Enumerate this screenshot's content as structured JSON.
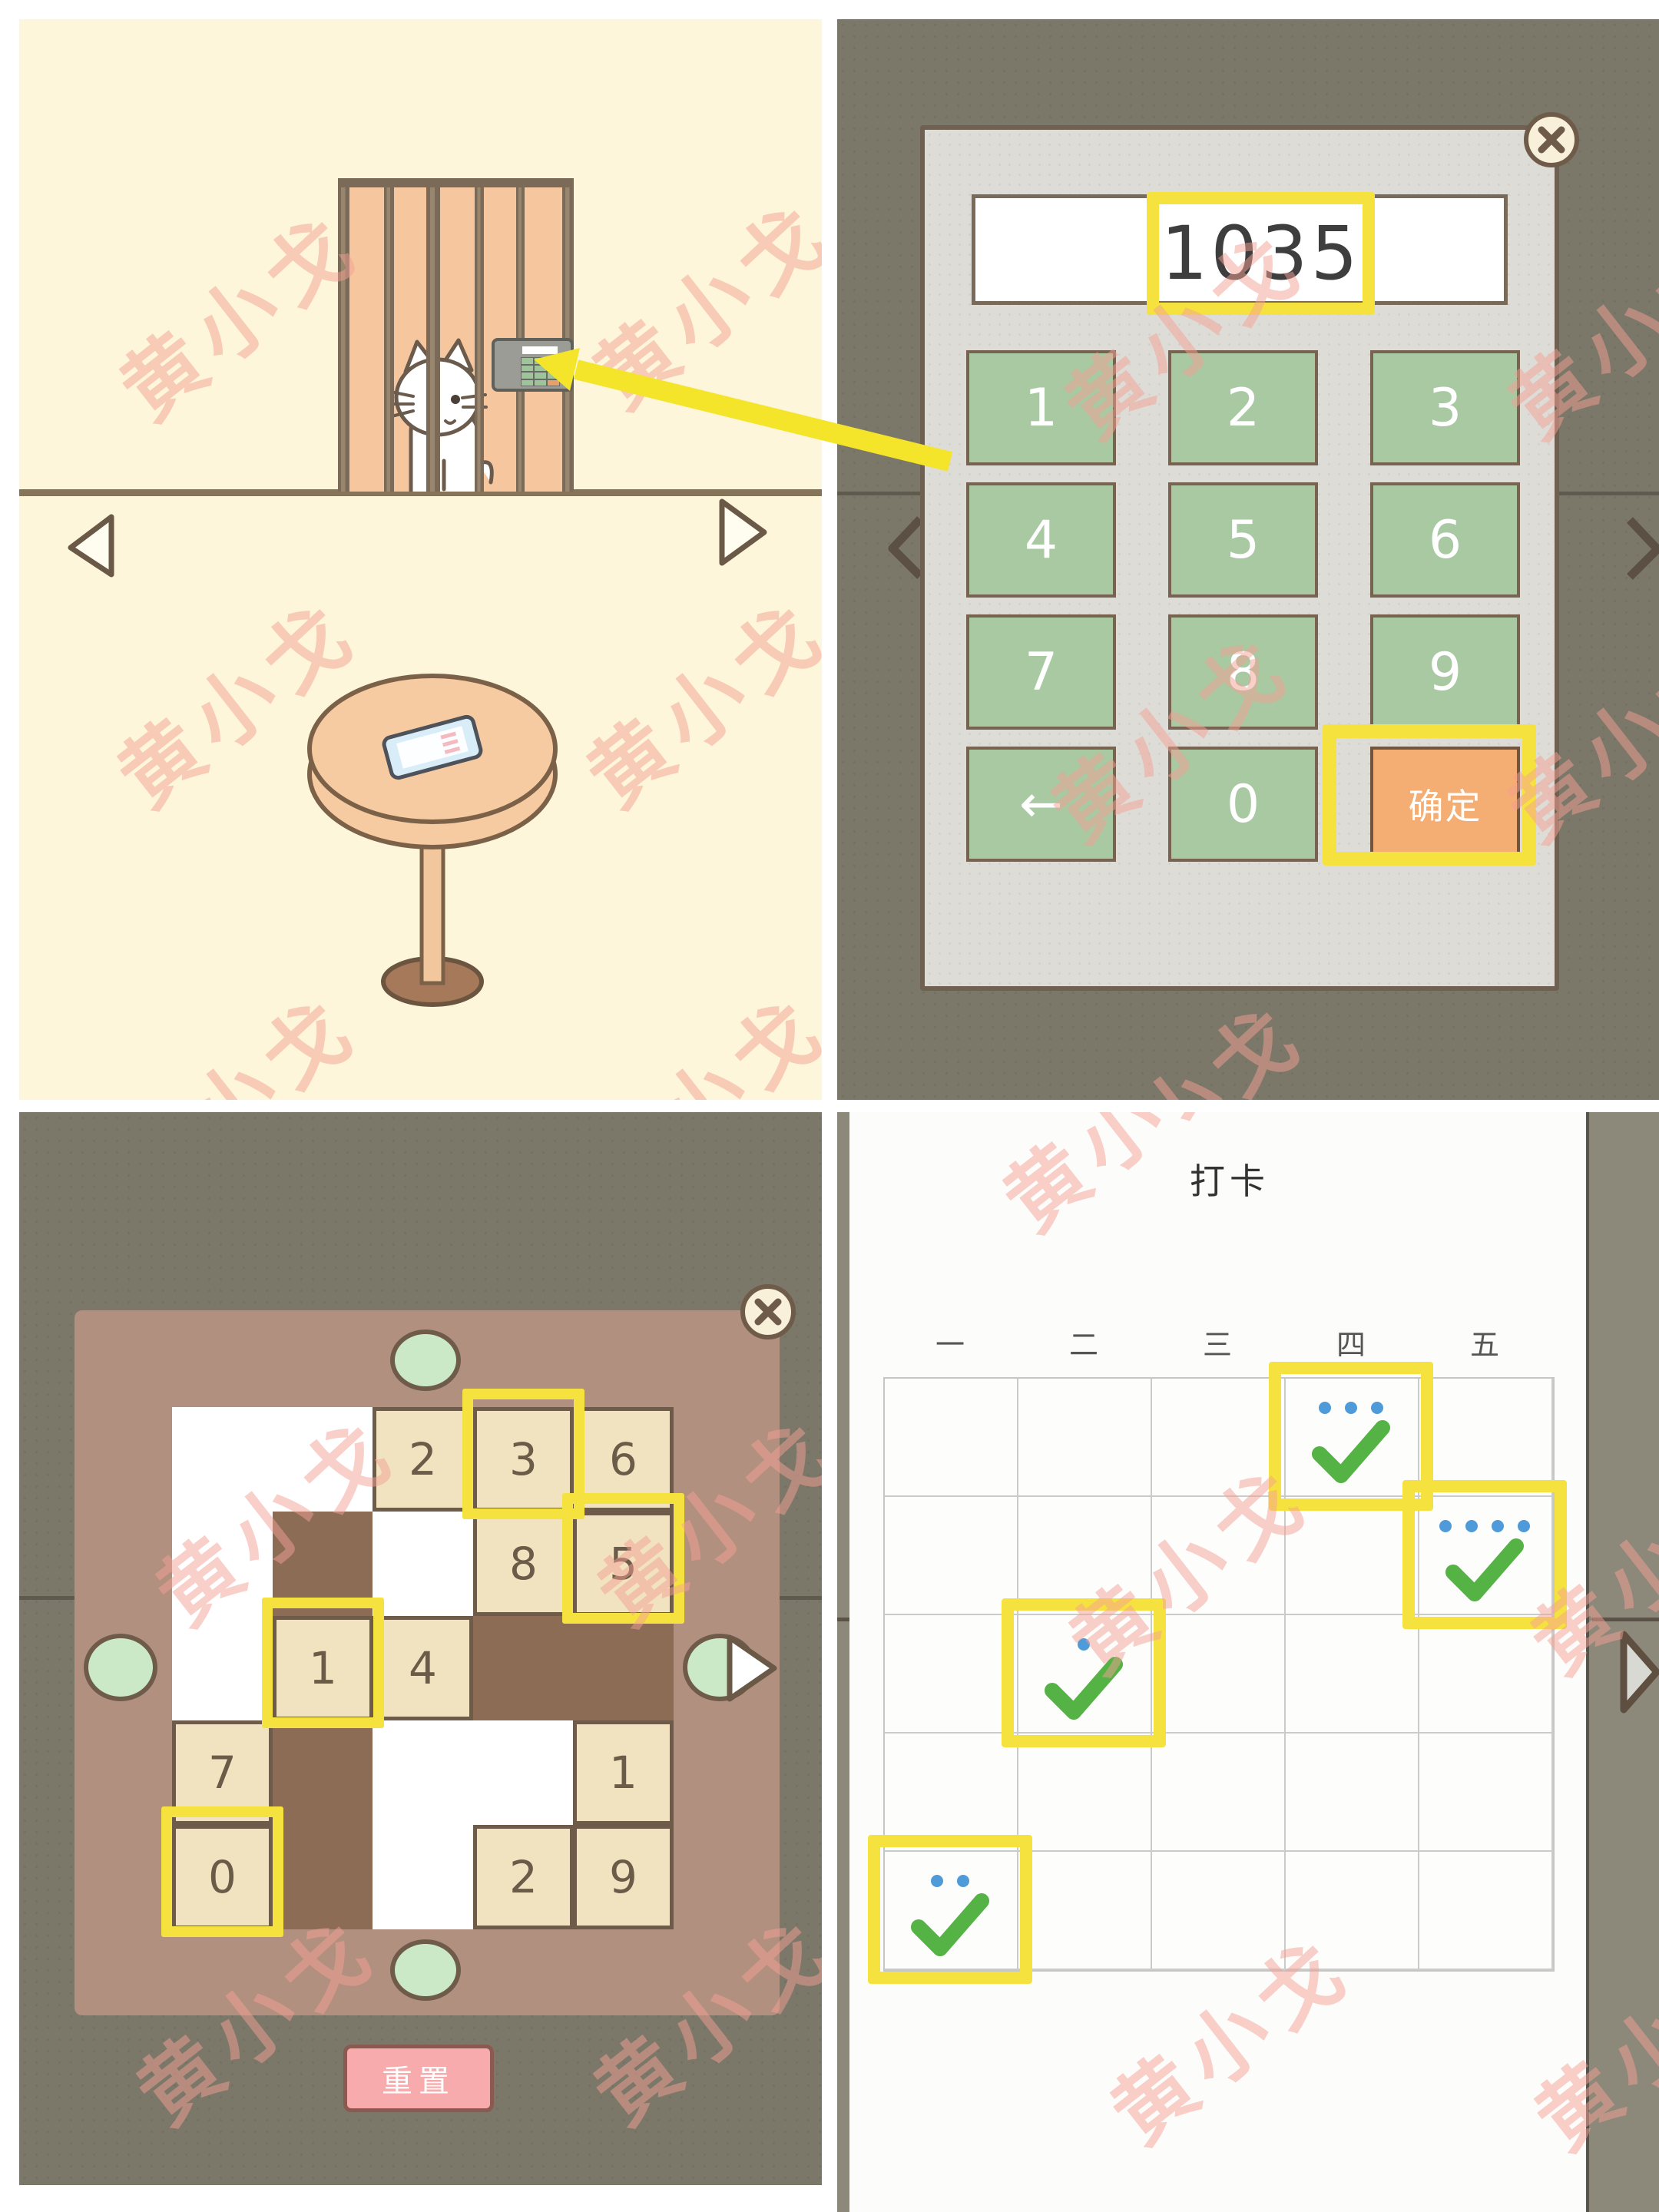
{
  "watermark": {
    "text": "黄小戈"
  },
  "colors": {
    "highlight_yellow": "#f6e23e",
    "arrow_yellow": "#f4e42a",
    "keypad_green": "#a9c9a3",
    "confirm_orange": "#f4ad72",
    "check_green": "#55b345",
    "dot_blue": "#4f9ad8",
    "reset_pink": "#f7abac",
    "board_brown": "#b29080",
    "background_olive": "#7b7869",
    "wall_cream": "#fdf6da"
  },
  "keypad": {
    "display_value": "1035",
    "buttons": [
      [
        "1",
        "2",
        "3"
      ],
      [
        "4",
        "5",
        "6"
      ],
      [
        "7",
        "8",
        "9"
      ],
      [
        "←",
        "0",
        "确定"
      ]
    ],
    "confirm_label": "确定",
    "back_label": "←"
  },
  "puzzle": {
    "grid": [
      [
        "empty",
        "empty",
        "2",
        "3",
        "6"
      ],
      [
        "empty",
        "hole",
        "empty",
        "8",
        "5"
      ],
      [
        "empty",
        "1",
        "4",
        "hole",
        "hole"
      ],
      [
        "7",
        "hole",
        "empty",
        "empty",
        "1"
      ],
      [
        "0",
        "hole",
        "empty",
        "2",
        "9"
      ]
    ],
    "highlights": [
      [
        0,
        3
      ],
      [
        1,
        4
      ],
      [
        2,
        1
      ],
      [
        4,
        0
      ]
    ],
    "reset_label": "重置"
  },
  "calendar": {
    "title": "打卡",
    "day_headers": [
      "一",
      "二",
      "三",
      "四",
      "五"
    ],
    "rows": 5,
    "cols": 5,
    "checks": [
      {
        "row": 0,
        "col": 3,
        "dots": 3,
        "highlight": true
      },
      {
        "row": 1,
        "col": 4,
        "dots": 4,
        "highlight": true
      },
      {
        "row": 2,
        "col": 1,
        "dots": 1,
        "highlight": true
      },
      {
        "row": 4,
        "col": 0,
        "dots": 2,
        "highlight": true
      }
    ]
  }
}
